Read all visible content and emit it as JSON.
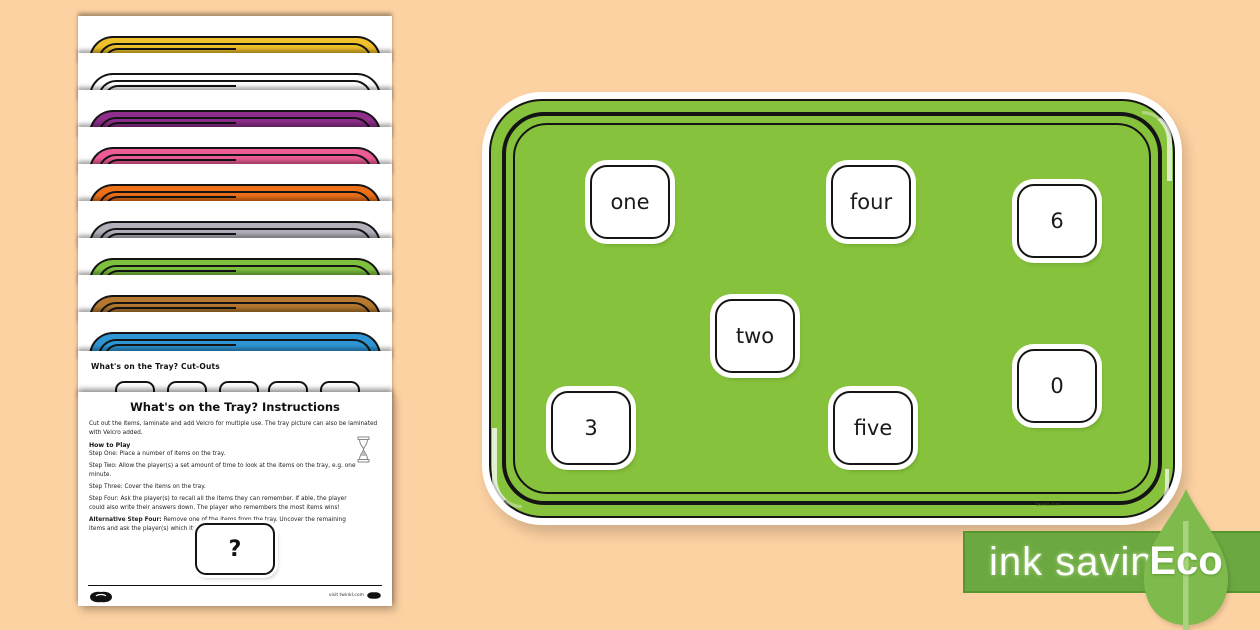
{
  "page": {
    "background": "#FDD2A2"
  },
  "stack": {
    "pages": [
      {
        "name": "yellow-tray",
        "color": "#F0C12A"
      },
      {
        "name": "white-tray",
        "color": "#FFFFFF"
      },
      {
        "name": "purple-tray",
        "color": "#8F2E8C"
      },
      {
        "name": "pink-tray",
        "color": "#EE5C97"
      },
      {
        "name": "orange-tray",
        "color": "#EE7118"
      },
      {
        "name": "silver-tray",
        "color": "#B3B0BC"
      },
      {
        "name": "green-tray",
        "color": "#7DC13F"
      },
      {
        "name": "brown-tray",
        "color": "#B6792F"
      },
      {
        "name": "blue-tray",
        "color": "#2E96D5"
      }
    ],
    "cutouts": {
      "title": "What's on the Tray?  Cut-Outs"
    },
    "instructions": {
      "title": "What's on the Tray? Instructions",
      "intro": "Cut out the items, laminate and add Velcro for multiple use. The tray picture can also be laminated with Velcro added.",
      "how_to_play_heading": "How to Play",
      "steps": [
        {
          "label": "Step One:",
          "text": "Place a number of items on the tray."
        },
        {
          "label": "Step Two:",
          "text": "Allow the player(s) a set amount of time to look at the items on the tray, e.g. one minute."
        },
        {
          "label": "Step Three:",
          "text": "Cover the items on the tray."
        },
        {
          "label": "Step Four:",
          "text": "Ask the player(s) to recall all the items they can remember. If able, the player could also write their answers down. The player who remembers the most items wins!"
        },
        {
          "label": "Alternative Step Four:",
          "text": "Remove one of the items from the tray. Uncover the remaining items and ask the player(s) which item is missing."
        }
      ],
      "question_card": "?",
      "footer_right": "visit twinkl.com"
    }
  },
  "tray": {
    "color": "#86C23C",
    "watermark": "twinkl.com",
    "cards": [
      {
        "label": "one"
      },
      {
        "label": "four"
      },
      {
        "label": "6"
      },
      {
        "label": "two"
      },
      {
        "label": "0"
      },
      {
        "label": "3"
      },
      {
        "label": "five"
      }
    ]
  },
  "eco": {
    "label": "ink saving",
    "eco_label": "Eco",
    "bar_color": "#6CA841",
    "leaf_color": "#7EBA4C",
    "stem_color": "#A9D47F"
  }
}
